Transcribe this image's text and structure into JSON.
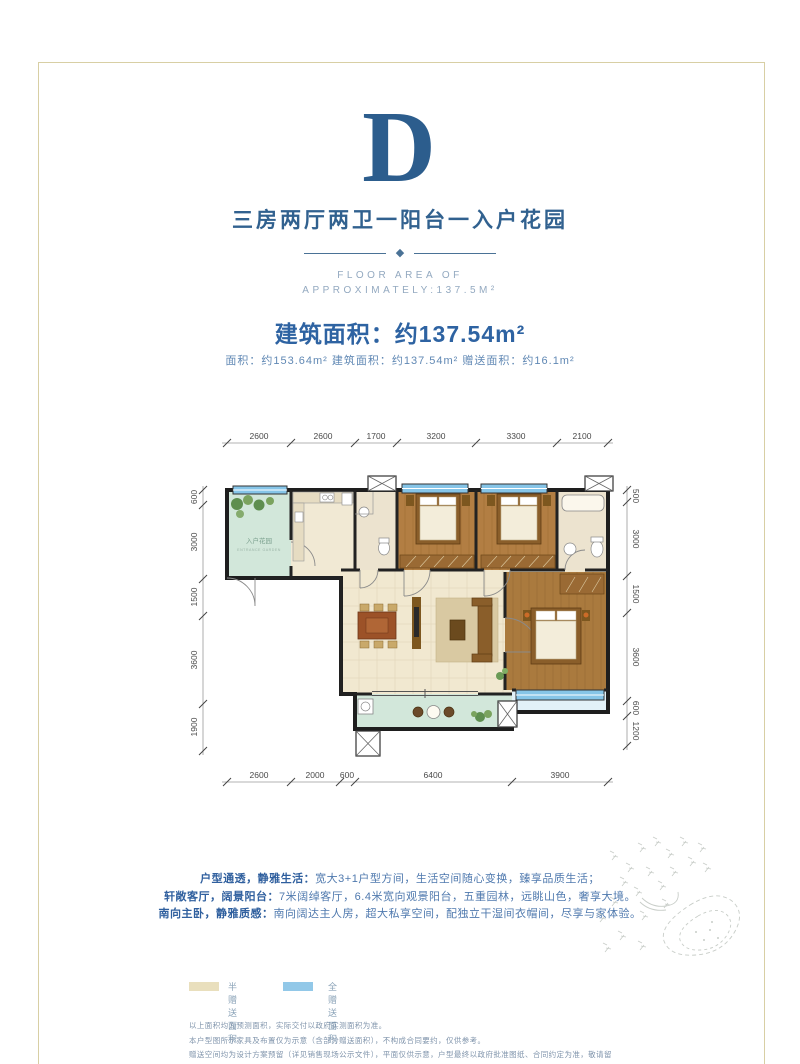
{
  "header": {
    "letter": "D",
    "subtitle": "三房两厅两卫一阳台一入户花园",
    "en_line1": "FLOOR AREA OF",
    "en_line2": "APPROXIMATELY:137.5M²",
    "area_title": "建筑面积：约137.54m²",
    "area_detail": "面积：约153.64m²   建筑面积：约137.54m²   赠送面积：约16.1m²"
  },
  "floorplan": {
    "dims_top": [
      "2600",
      "2600",
      "1700",
      "3200",
      "3300",
      "2100"
    ],
    "dims_bottom": [
      "2600",
      "2000",
      "600",
      "6400",
      "3900"
    ],
    "dims_left": [
      "600",
      "3000",
      "1500",
      "3600",
      "1900"
    ],
    "dims_right": [
      "500",
      "3000",
      "1500",
      "3600",
      "600",
      "1200"
    ],
    "labels": {
      "entry_garden": "入户花园",
      "entry_garden_en": "ENTRANCE GARDEN"
    }
  },
  "description": {
    "lines": [
      {
        "lead": "户型通透，静雅生活：",
        "text": "宽大3+1户型方间，生活空间随心变换，臻享品质生活；"
      },
      {
        "lead": "轩敞客厅，阔景阳台：",
        "text": "7米阔绰客厅，6.4米宽向观景阳台，五重园林，远眺山色，奢享大境。"
      },
      {
        "lead": "南向主卧，静雅质感：",
        "text": "南向阔达主人房，超大私享空间，配独立干湿间衣帽间，尽享与家体验。"
      }
    ]
  },
  "legend": {
    "items": [
      {
        "label": "半赠送面积",
        "color": "#e9dfbd"
      },
      {
        "label": "全赠送面积",
        "color": "#92c8e8"
      }
    ]
  },
  "disclaimer": {
    "lines": [
      "以上面积均为预测面积，实际交付以政府实测面积为准。",
      "本户型图所示家具及布置仅为示意（含部分赠送面积），不构成合同要约，仅供参考。",
      "赠送空间均为设计方案预留（详见销售现场公示文件），平面仅供示意，户型最终以政府批准图纸、合同约定为准，敬请留意。"
    ]
  },
  "colors": {
    "heading_blue": "#2c5d8d",
    "body_blue": "#4f79ae",
    "frame_tan": "#d8cfa4",
    "wood": "#b27e43",
    "tile": "#f1e8d0",
    "mint": "#d2e7da",
    "window_blue": "#86c5e8"
  }
}
